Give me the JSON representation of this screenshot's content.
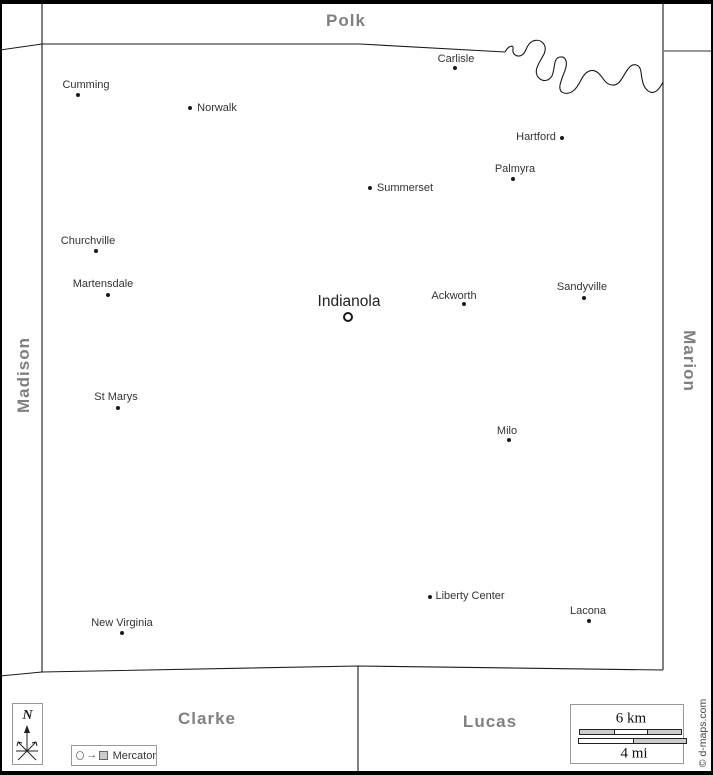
{
  "neighbors": {
    "north": "Polk",
    "west": "Madison",
    "east": "Marion",
    "south_west": "Clarke",
    "south_east": "Lucas"
  },
  "county_seat": "Indianola",
  "towns": [
    {
      "name": "Cumming",
      "dot": [
        78,
        95
      ],
      "label": [
        86,
        85
      ]
    },
    {
      "name": "Norwalk",
      "dot": [
        190,
        108
      ],
      "label": [
        217,
        108
      ]
    },
    {
      "name": "Carlisle",
      "dot": [
        455,
        68
      ],
      "label": [
        456,
        59
      ]
    },
    {
      "name": "Hartford",
      "dot": [
        562,
        138
      ],
      "label": [
        536,
        137
      ]
    },
    {
      "name": "Palmyra",
      "dot": [
        513,
        179
      ],
      "label": [
        515,
        169
      ]
    },
    {
      "name": "Summerset",
      "dot": [
        370,
        188
      ],
      "label": [
        405,
        188
      ]
    },
    {
      "name": "Churchville",
      "dot": [
        96,
        251
      ],
      "label": [
        88,
        241
      ]
    },
    {
      "name": "Martensdale",
      "dot": [
        108,
        295
      ],
      "label": [
        103,
        284
      ]
    },
    {
      "name": "Indianola",
      "dot": [
        348,
        317
      ],
      "label": [
        349,
        302
      ],
      "seat": true
    },
    {
      "name": "Ackworth",
      "dot": [
        464,
        304
      ],
      "label": [
        454,
        296
      ]
    },
    {
      "name": "Sandyville",
      "dot": [
        584,
        298
      ],
      "label": [
        582,
        287
      ]
    },
    {
      "name": "St Marys",
      "dot": [
        118,
        408
      ],
      "label": [
        116,
        397
      ]
    },
    {
      "name": "Milo",
      "dot": [
        509,
        440
      ],
      "label": [
        507,
        431
      ]
    },
    {
      "name": "Liberty Center",
      "dot": [
        430,
        597
      ],
      "label": [
        470,
        596
      ]
    },
    {
      "name": "Lacona",
      "dot": [
        589,
        621
      ],
      "label": [
        588,
        611
      ]
    },
    {
      "name": "New Virginia",
      "dot": [
        122,
        633
      ],
      "label": [
        122,
        623
      ]
    }
  ],
  "compass": {
    "label": "N"
  },
  "legend": {
    "projection": "Mercator"
  },
  "scale": {
    "km": "6 km",
    "mi": "4 mi"
  },
  "copyright": "© d-maps.com",
  "colors": {
    "county_label": "#808080",
    "boundary_line": "#1a1a1a",
    "secondary_boundary": "#999999",
    "scale_fill": "#cccccc"
  }
}
